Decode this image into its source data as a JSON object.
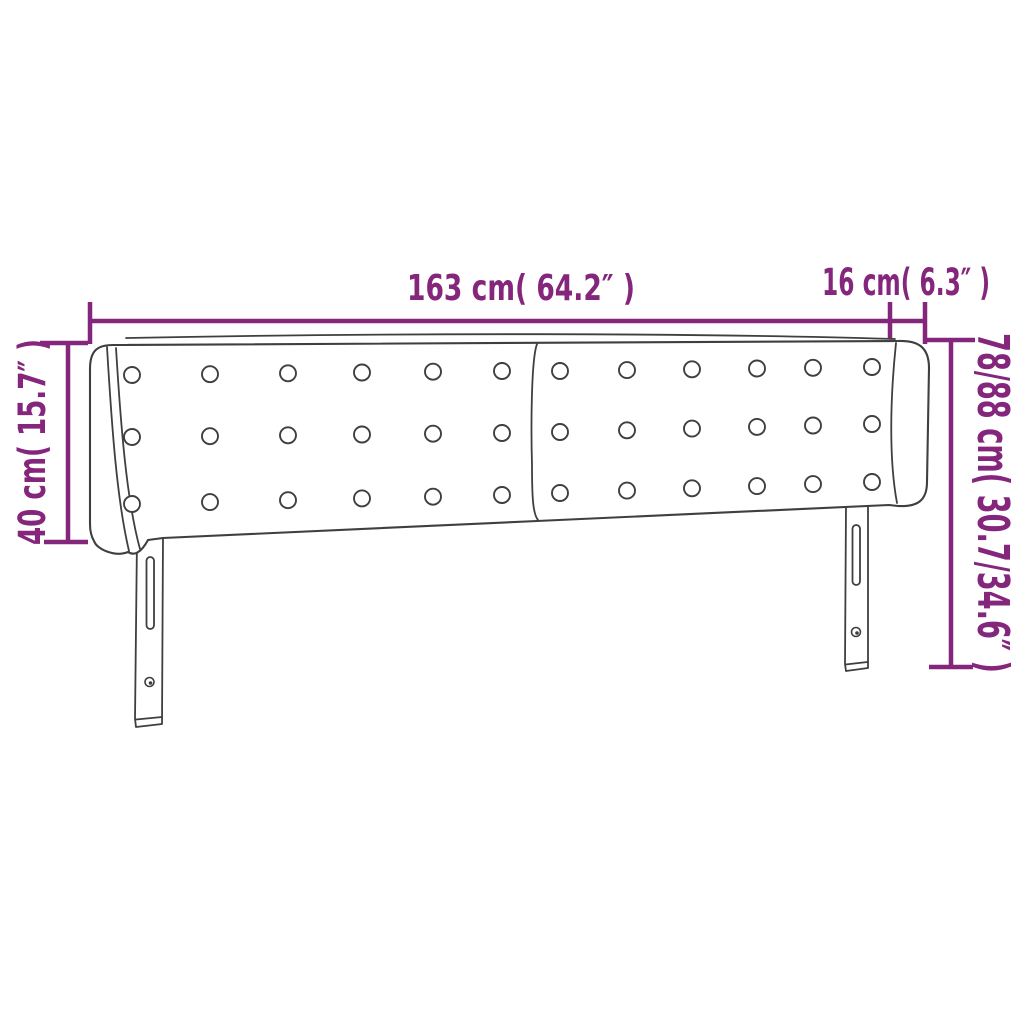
{
  "figure": {
    "type": "technical-line-drawing",
    "subject": "upholstered headboard with winged sides, button tufting and two slotted mounting legs"
  },
  "colors": {
    "accent": "#85267d",
    "outline": "#3f3f3f",
    "background": "#ffffff"
  },
  "dimension_labels": {
    "total_width": "163 cm( 64.2″ )",
    "wing_depth": "16 cm( 6.3″ )",
    "wing_height": "40 cm( 15.7″ )",
    "total_height": "78/88 cm( 30.7/34.6″ )"
  }
}
